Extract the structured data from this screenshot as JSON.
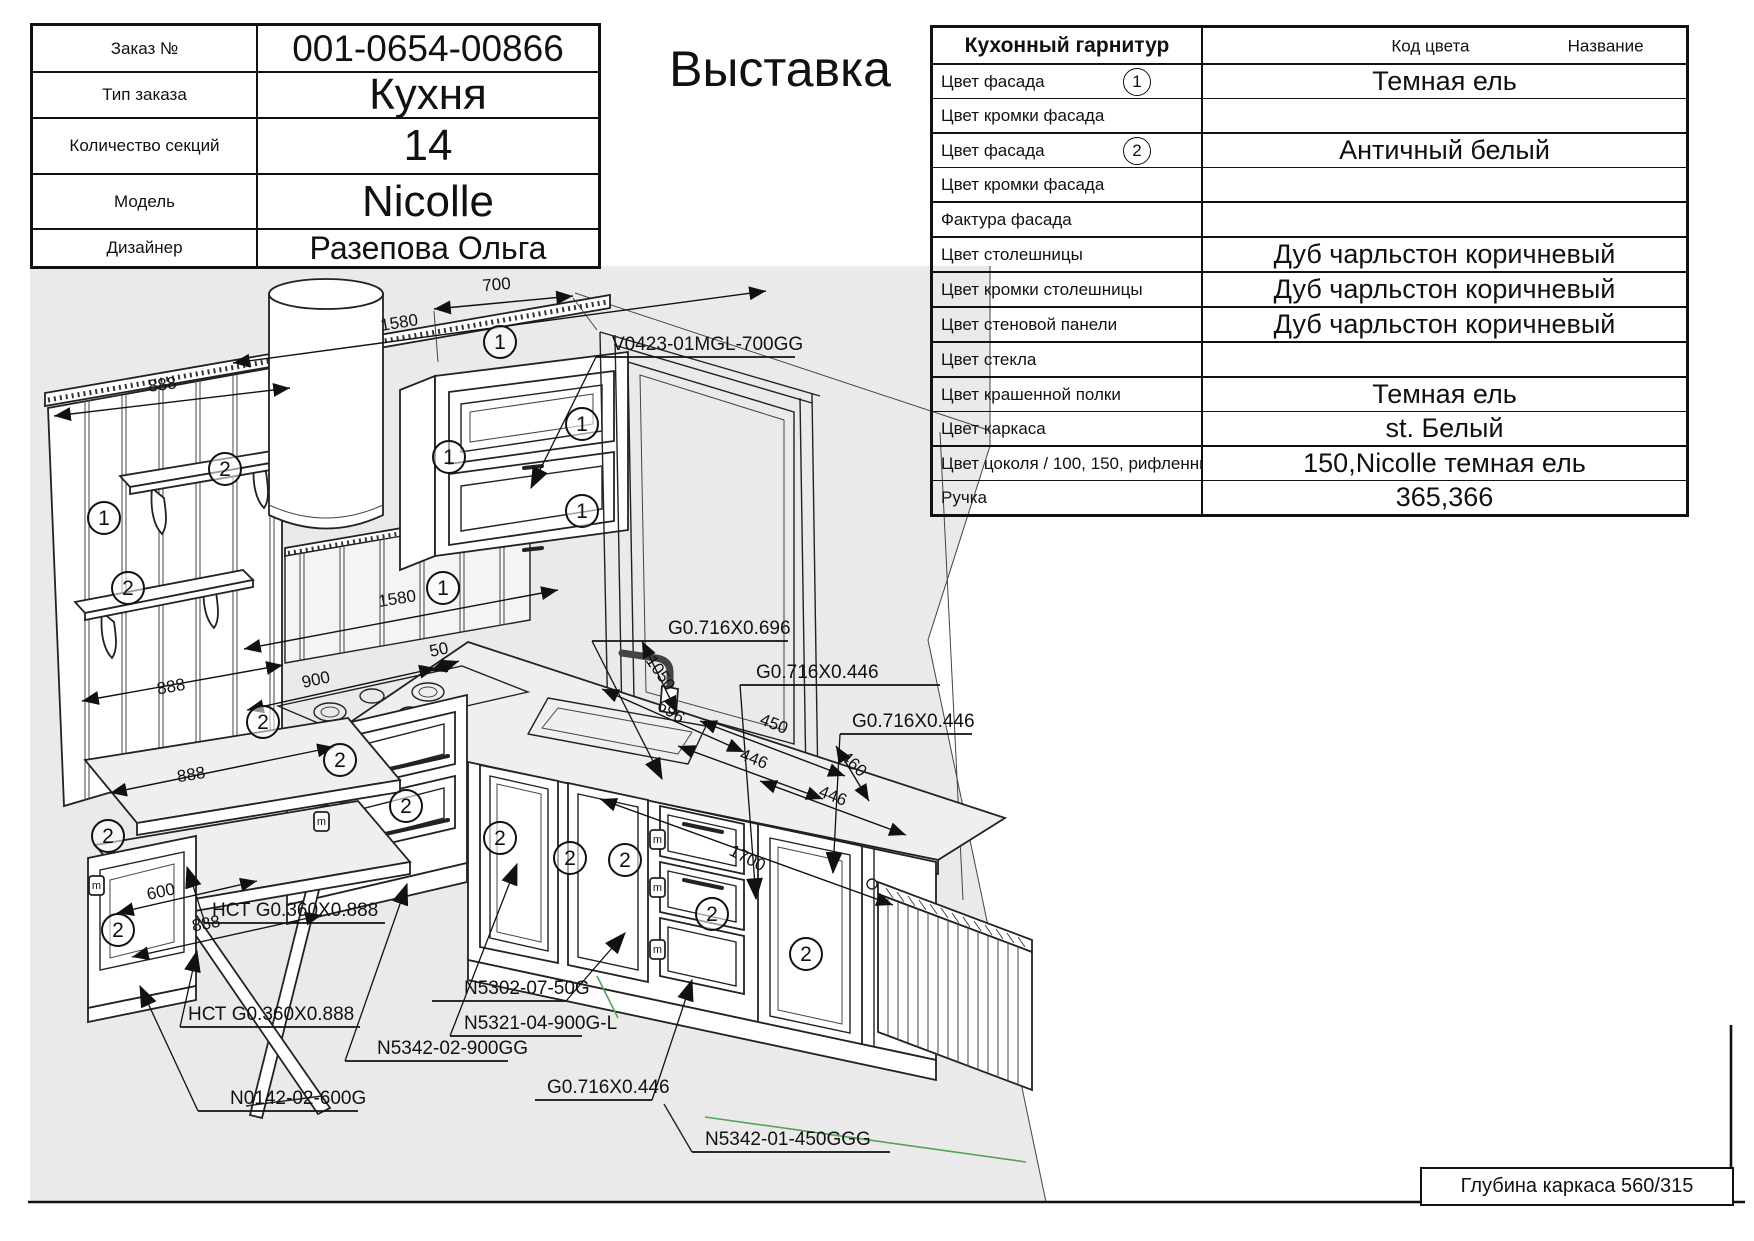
{
  "title": "Выставка",
  "order_table": {
    "rows": [
      {
        "label": "Заказ №",
        "value": "001-0654-00866"
      },
      {
        "label": "Тип заказа",
        "value": "Кухня"
      },
      {
        "label": "Количество секций",
        "value": "14"
      },
      {
        "label": "Модель",
        "value": "Nicolle"
      },
      {
        "label": "Дизайнер",
        "value": "Разепова Ольга"
      }
    ]
  },
  "spec_table": {
    "title": "Кухонный гарнитур",
    "col_code": "Код цвета",
    "col_name": "Название",
    "rows": [
      {
        "label": "Цвет фасада",
        "marker": "1",
        "value": "Темная ель"
      },
      {
        "label": "Цвет кромки фасада",
        "value": ""
      },
      {
        "label": "Цвет фасада",
        "marker": "2",
        "value": "Античный белый"
      },
      {
        "label": "Цвет кромки фасада",
        "value": ""
      },
      {
        "label": "Фактура фасада",
        "value": ""
      },
      {
        "label": "Цвет столешницы",
        "value": "Дуб чарльстон коричневый"
      },
      {
        "label": "Цвет кромки столешницы",
        "value": "Дуб чарльстон коричневый"
      },
      {
        "label": "Цвет стеновой панели",
        "value": "Дуб чарльстон коричневый"
      },
      {
        "label": "Цвет стекла",
        "value": ""
      },
      {
        "label": "Цвет крашенной полки",
        "value": "Темная ель"
      },
      {
        "label": "Цвет каркаса",
        "value": "st. Белый"
      },
      {
        "label": "Цвет цоколя / 100, 150, рифленный",
        "value": "150,Nicolle темная ель"
      },
      {
        "label": "Ручка",
        "value": "365,366"
      }
    ]
  },
  "frame": {
    "carcass_depth": "Глубина каркаса 560/315"
  },
  "drawing": {
    "dims": {
      "d700": "700",
      "d1580_top": "1580",
      "d888_wall": "888",
      "d1580_mid": "1580",
      "d900": "900",
      "d50": "50",
      "d888_side": "888",
      "d888_table_top": "888",
      "d600": "600",
      "d888_table_bot": "888",
      "d1050": "1050",
      "d696": "696",
      "d450": "450",
      "d446_a": "446",
      "d460": "460",
      "d446_b": "446",
      "d1700": "1700"
    },
    "labels": {
      "hood_cab": "V0423-01MGL-700GG",
      "counter_696": "G0.716X0.696",
      "counter_446a": "G0.716X0.446",
      "counter_446b": "G0.716X0.446",
      "counter_446c": "G0.716X0.446",
      "table_top_a": "НСТ G0.360X0.888",
      "table_top_b": "НСТ G0.360X0.888",
      "plinth": "N5302-07-50G",
      "sink_cabinet": "N5321-04-900G-L",
      "stove_cabinet": "N5342-02-900GG",
      "table_cabinet": "N0142-02-600G",
      "corner_cabinet": "N5342-01-450GGG"
    },
    "markers": {
      "one": "1",
      "two": "2",
      "m": "m"
    }
  }
}
